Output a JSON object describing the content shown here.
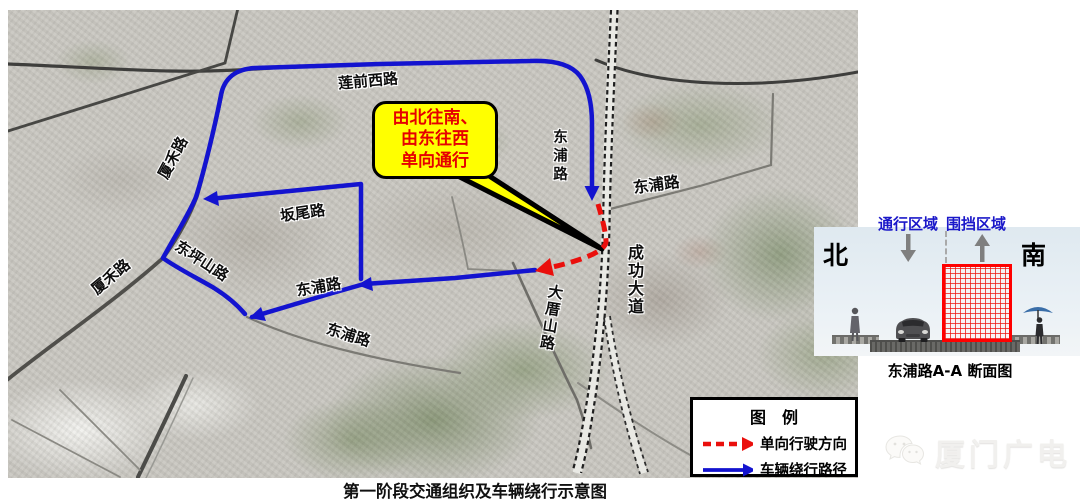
{
  "map": {
    "labels": {
      "lianqian_west": "莲前西路",
      "xiahe_upper": "厦禾路",
      "xiahe_lower": "厦禾路",
      "banwei": "坂尾路",
      "dongpingshan": "东坪山路",
      "dongpu_mid": "东浦路",
      "dongpu_lower": "东浦路",
      "dongpu_north": "东浦路",
      "dongpu_east": "东浦路",
      "chenggong_ave": "成功大道",
      "dacuoshan": "大厝山路"
    },
    "callout": {
      "line1": "由北往南、",
      "line2": "由东往西",
      "line3": "单向通行"
    }
  },
  "legend": {
    "title": "图　例",
    "item1": "单向行驶方向",
    "item2": "车辆绕行路径"
  },
  "cross_section": {
    "zone_open": "通行区域",
    "zone_closed": "围挡区域",
    "north": "北",
    "south": "南",
    "caption": "东浦路A-A 断面图"
  },
  "footer": {
    "caption": "第一阶段交通组织及车辆绕行示意图"
  },
  "watermark": {
    "text": "厦门广电",
    "icon": "wechat-logo-icon"
  },
  "colors": {
    "detour_route_blue": "#1313cf",
    "oneway_red": "#e8100c",
    "callout_bg": "#ffff00",
    "callout_text": "#e60000",
    "zone_label_blue": "#1a17c9",
    "barrier_mesh_red": "#ff0000"
  }
}
